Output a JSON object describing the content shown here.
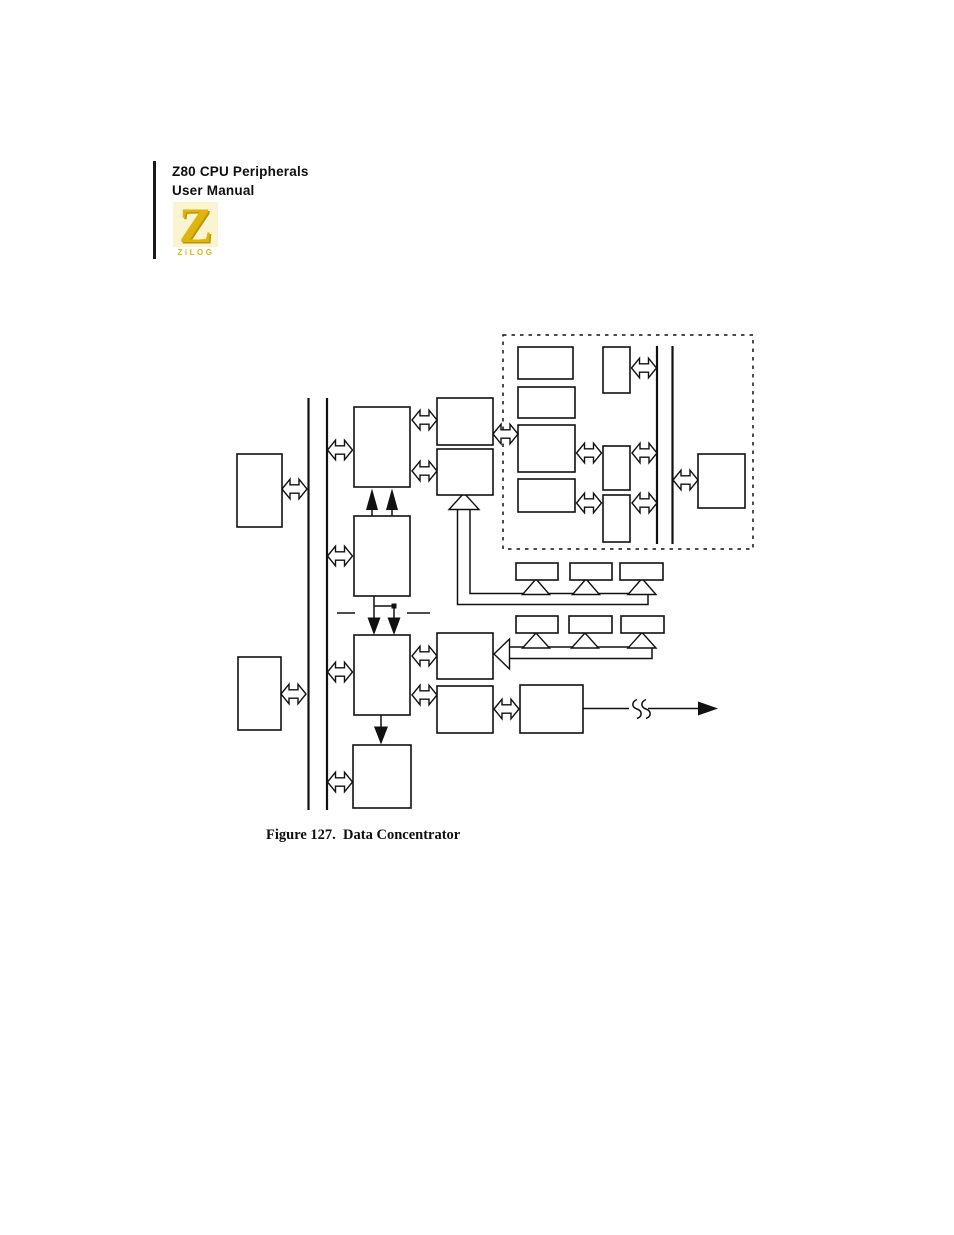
{
  "header": {
    "line1": "Z80 CPU Peripherals",
    "line2": "User Manual"
  },
  "logo": {
    "letter": "Z",
    "wordmark": "ZiLOG"
  },
  "figure": {
    "caption": "Figure 127.  Data Concentrator"
  },
  "colors": {
    "brand-gold": "#dfb40e",
    "logo-bg": "#faf4d0",
    "ink": "#111111"
  }
}
